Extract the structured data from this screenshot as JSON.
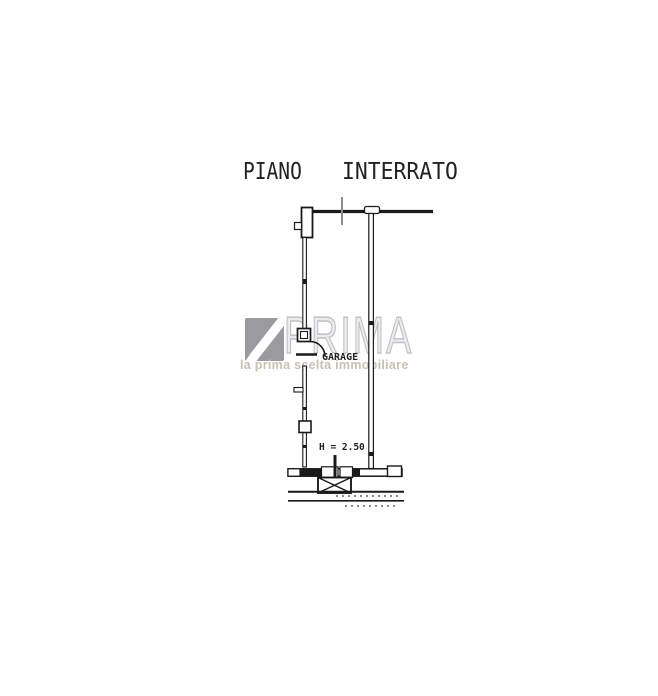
{
  "title": {
    "word1": "PIANO",
    "word2": "INTERRATO"
  },
  "plan": {
    "room_label": "GARAGE",
    "height_label": "H = 2.50"
  },
  "watermark": {
    "brand": "PRIMA",
    "tagline": "la prima scelta immobiliare"
  },
  "colors": {
    "plan_line": "#1a1a1a",
    "section_tick": "#8c8c8c",
    "logo_gray": "#9b9b9f",
    "brand_outline": "#c2c2c6",
    "tagline_gray": "#c8c0b4"
  }
}
